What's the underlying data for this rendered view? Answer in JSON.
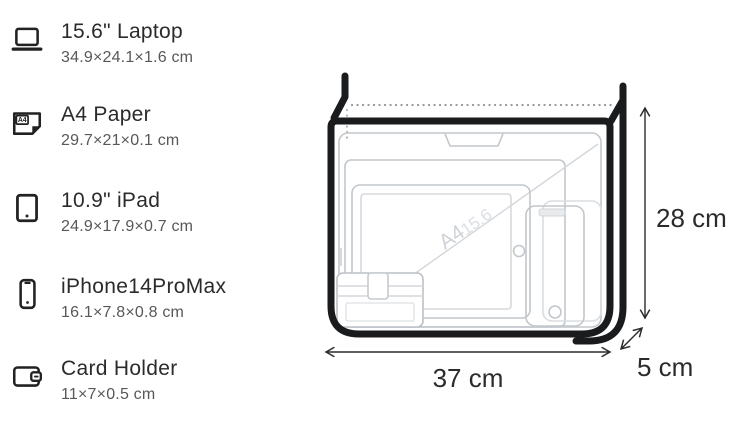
{
  "items": [
    {
      "label": "15.6\" Laptop",
      "size": "34.9×24.1×1.6 cm"
    },
    {
      "label": "A4 Paper",
      "size": "29.7×21×0.1 cm",
      "icon_text": "A4"
    },
    {
      "label": "10.9\" iPad",
      "size": "24.9×17.9×0.7 cm"
    },
    {
      "label": "iPhone14ProMax",
      "size": "16.1×7.8×0.8 cm"
    },
    {
      "label": "Card Holder",
      "size": "11×7×0.5 cm"
    }
  ],
  "diagram": {
    "width_label": "37 cm",
    "height_label": "28 cm",
    "depth_label": "5 cm",
    "watermark_a4": "A4",
    "watermark_diagonal": "15.6"
  },
  "colors": {
    "bag_outline": "#1a1b1d",
    "item_outline": "#c2c7cc",
    "title_text": "#2b2b2b",
    "subtitle_text": "#585858"
  }
}
